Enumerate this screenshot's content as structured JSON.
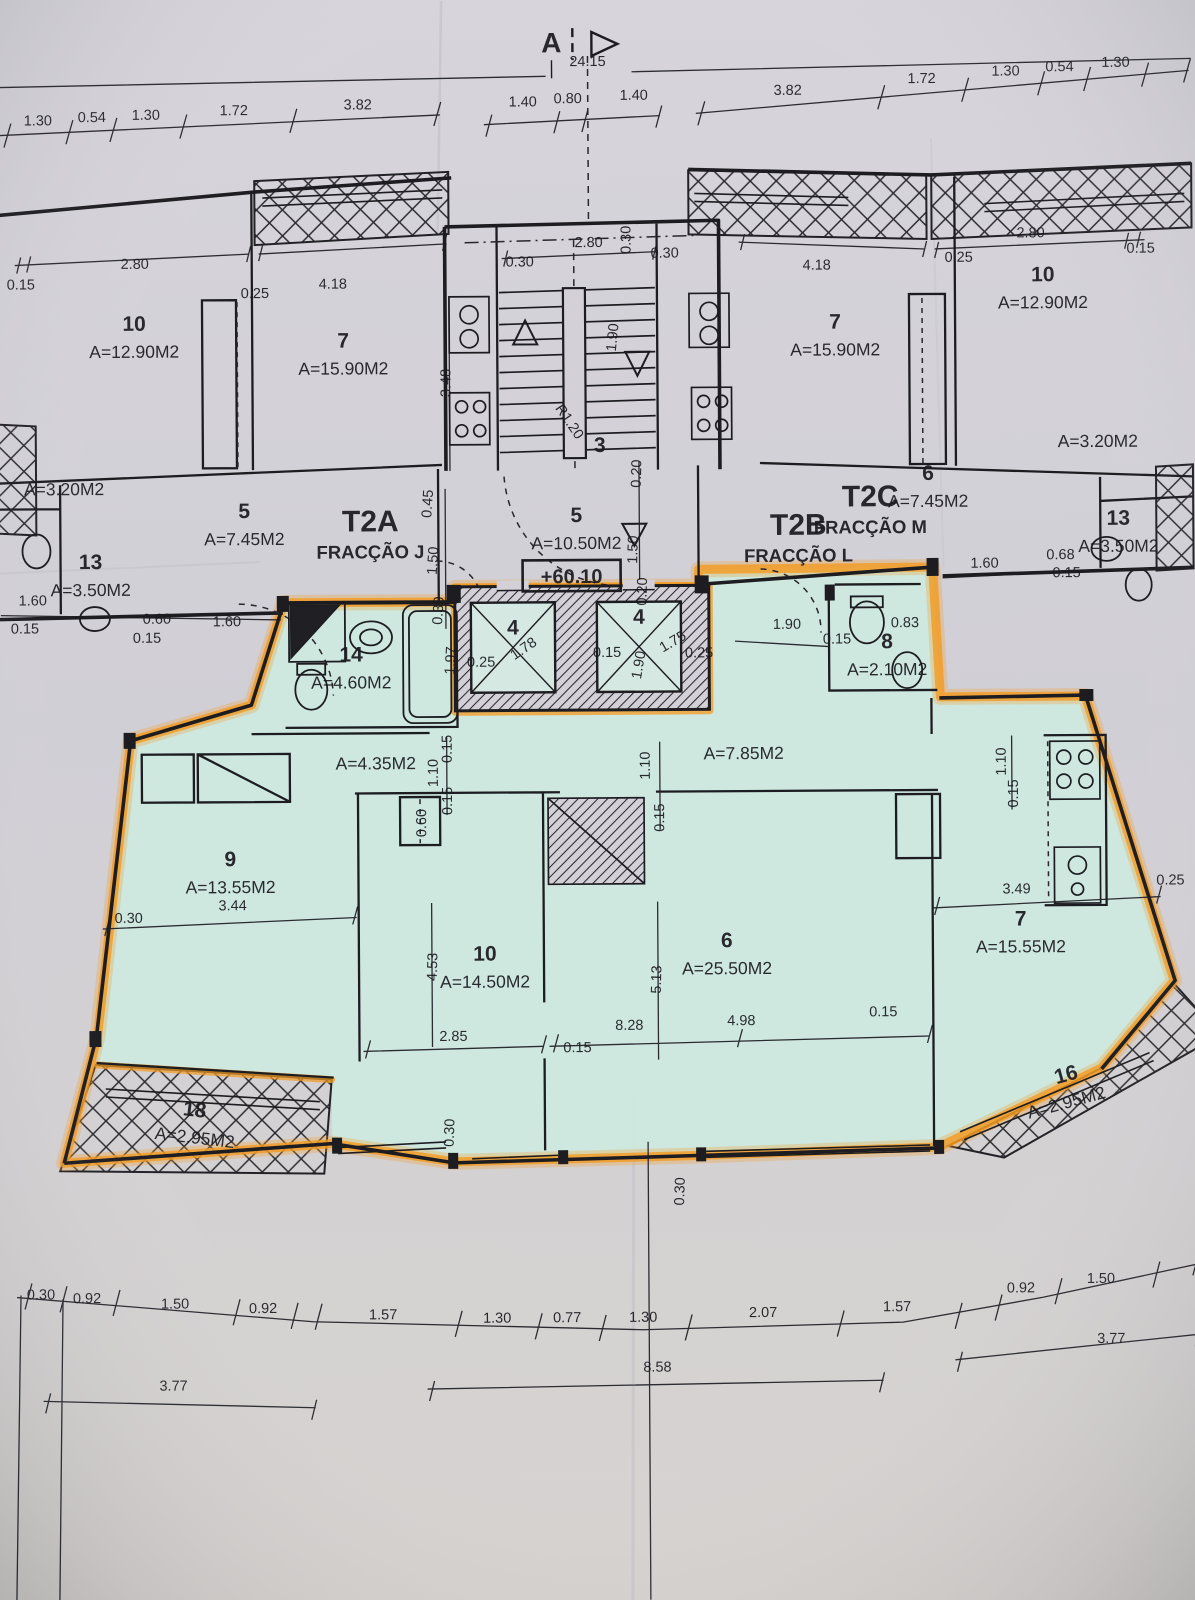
{
  "document": {
    "kind": "architectural floor plan (photographed blueprint)",
    "overall_width_label": "24.15"
  },
  "section_marker": {
    "letter": "A"
  },
  "level_marker": "+60.10",
  "colors": {
    "paper": "#d3d1d7",
    "highlight_teal": "#cde9e0",
    "highlighter_orange": "#f49a1f",
    "ink": "#1c1c20"
  },
  "fractions": [
    {
      "code": "T2A",
      "name": "FRACÇÃO J",
      "x": 372,
      "y": 530
    },
    {
      "code": "T2B",
      "name": "FRACÇÃO L",
      "x": 800,
      "y": 536
    },
    {
      "code": "T2C",
      "name": "FRACÇÃO M",
      "x": 872,
      "y": 508
    }
  ],
  "rooms": [
    {
      "n": "10",
      "a": "A=12.90M2",
      "x": 137,
      "y": 328
    },
    {
      "n": "7",
      "a": "A=15.90M2",
      "x": 346,
      "y": 346
    },
    {
      "n": "",
      "a": "A=3.20M2",
      "x": 66,
      "y": 492
    },
    {
      "n": "5",
      "a": "A=7.45M2",
      "x": 246,
      "y": 516
    },
    {
      "n": "13",
      "a": "A=3.50M2",
      "x": 92,
      "y": 566
    },
    {
      "n": "3",
      "a": "",
      "x": 602,
      "y": 452
    },
    {
      "n": "5",
      "a": "A=10.50M2",
      "x": 578,
      "y": 522
    },
    {
      "n": "7",
      "a": "A=15.90M2",
      "x": 838,
      "y": 330
    },
    {
      "n": "10",
      "a": "A=12.90M2",
      "x": 1046,
      "y": 284
    },
    {
      "n": "",
      "a": "A=3.20M2",
      "x": 1100,
      "y": 450
    },
    {
      "n": "6",
      "a": "A=7.45M2",
      "x": 930,
      "y": 482
    },
    {
      "n": "13",
      "a": "A=3.50M2",
      "x": 1120,
      "y": 528
    },
    {
      "n": "14",
      "a": "A=4.60M2",
      "x": 352,
      "y": 660
    },
    {
      "n": "4",
      "a": "",
      "x": 514,
      "y": 634
    },
    {
      "n": "4",
      "a": "",
      "x": 640,
      "y": 624
    },
    {
      "n": "8",
      "a": "A=2.10M2",
      "x": 888,
      "y": 650
    },
    {
      "n": "",
      "a": "A=4.35M2",
      "x": 376,
      "y": 768
    },
    {
      "n": "",
      "a": "A=7.85M2",
      "x": 744,
      "y": 760
    },
    {
      "n": "9",
      "a": "A=13.55M2",
      "x": 230,
      "y": 864
    },
    {
      "n": "10",
      "a": "A=14.50M2",
      "x": 484,
      "y": 960
    },
    {
      "n": "6",
      "a": "A=25.50M2",
      "x": 726,
      "y": 948
    },
    {
      "n": "7",
      "a": "A=15.55M2",
      "x": 1020,
      "y": 928
    },
    {
      "n": "18",
      "a": "A=2.95M2",
      "x": 192,
      "y": 1114,
      "r": 7
    },
    {
      "n": "16",
      "a": "A=2.95M2",
      "x": 1066,
      "y": 1084,
      "r": -15
    }
  ],
  "dimensions": [
    {
      "t": "24.15",
      "x": 592,
      "y": 66
    },
    {
      "t": "1.30",
      "x": 42,
      "y": 122
    },
    {
      "t": "0.54",
      "x": 96,
      "y": 119
    },
    {
      "t": "1.30",
      "x": 150,
      "y": 117
    },
    {
      "t": "1.72",
      "x": 238,
      "y": 113
    },
    {
      "t": "3.82",
      "x": 362,
      "y": 108
    },
    {
      "t": "1.40",
      "x": 527,
      "y": 106
    },
    {
      "t": "0.80",
      "x": 572,
      "y": 103
    },
    {
      "t": "1.40",
      "x": 638,
      "y": 100
    },
    {
      "t": "3.82",
      "x": 792,
      "y": 96
    },
    {
      "t": "1.72",
      "x": 926,
      "y": 85
    },
    {
      "t": "1.30",
      "x": 1010,
      "y": 78
    },
    {
      "t": "0.54",
      "x": 1064,
      "y": 74
    },
    {
      "t": "1.30",
      "x": 1120,
      "y": 70
    },
    {
      "t": "0.15",
      "x": 24,
      "y": 286
    },
    {
      "t": "2.80",
      "x": 138,
      "y": 266
    },
    {
      "t": "0.25",
      "x": 258,
      "y": 296
    },
    {
      "t": "4.18",
      "x": 336,
      "y": 287
    },
    {
      "t": "3.48",
      "x": 453,
      "y": 382,
      "r": -90
    },
    {
      "t": "2.80",
      "x": 592,
      "y": 247
    },
    {
      "t": "0.30",
      "x": 523,
      "y": 266
    },
    {
      "t": "0.30",
      "x": 668,
      "y": 258
    },
    {
      "t": "0.30",
      "x": 634,
      "y": 240,
      "r": -90
    },
    {
      "t": "1.90",
      "x": 620,
      "y": 338,
      "r": -84
    },
    {
      "t": "R1.20",
      "x": 568,
      "y": 424,
      "r": 56
    },
    {
      "t": "4.18",
      "x": 820,
      "y": 271
    },
    {
      "t": "0.25",
      "x": 962,
      "y": 264
    },
    {
      "t": "2.80",
      "x": 1034,
      "y": 240
    },
    {
      "t": "0.15",
      "x": 1144,
      "y": 256
    },
    {
      "t": "0.45",
      "x": 434,
      "y": 503,
      "r": -86
    },
    {
      "t": "1.50",
      "x": 439,
      "y": 560,
      "r": -86
    },
    {
      "t": "0.30",
      "x": 444,
      "y": 610,
      "r": -86
    },
    {
      "t": "1.50",
      "x": 639,
      "y": 550,
      "r": -88
    },
    {
      "t": "0.20",
      "x": 648,
      "y": 592,
      "r": -88
    },
    {
      "t": "0.20",
      "x": 643,
      "y": 474,
      "r": -88
    },
    {
      "t": "1.60",
      "x": 34,
      "y": 602
    },
    {
      "t": "0.15",
      "x": 26,
      "y": 630
    },
    {
      "t": "0.60",
      "x": 158,
      "y": 621
    },
    {
      "t": "0.15",
      "x": 148,
      "y": 640
    },
    {
      "t": "1.60",
      "x": 228,
      "y": 624
    },
    {
      "t": "1.60",
      "x": 986,
      "y": 570
    },
    {
      "t": "0.68",
      "x": 1062,
      "y": 562
    },
    {
      "t": "0.15",
      "x": 1068,
      "y": 580
    },
    {
      "t": "0.25",
      "x": 482,
      "y": 666
    },
    {
      "t": "1.78",
      "x": 527,
      "y": 652,
      "r": -34
    },
    {
      "t": "0.15",
      "x": 608,
      "y": 657
    },
    {
      "t": "1.90",
      "x": 644,
      "y": 666,
      "r": -80
    },
    {
      "t": "1.75",
      "x": 676,
      "y": 646,
      "r": -30
    },
    {
      "t": "0.25",
      "x": 700,
      "y": 658
    },
    {
      "t": "1.97",
      "x": 456,
      "y": 660,
      "r": -86
    },
    {
      "t": "1.90",
      "x": 788,
      "y": 630
    },
    {
      "t": "0.15",
      "x": 838,
      "y": 645
    },
    {
      "t": "0.83",
      "x": 906,
      "y": 629
    },
    {
      "t": "1.10",
      "x": 438,
      "y": 772,
      "r": -90
    },
    {
      "t": "0.15",
      "x": 452,
      "y": 748,
      "r": -90
    },
    {
      "t": "0.15",
      "x": 452,
      "y": 800,
      "r": -90
    },
    {
      "t": "1.10",
      "x": 650,
      "y": 766,
      "r": -90
    },
    {
      "t": "0.15",
      "x": 664,
      "y": 818,
      "r": -90
    },
    {
      "t": "1.10",
      "x": 1006,
      "y": 764,
      "r": -90
    },
    {
      "t": "0.15",
      "x": 1018,
      "y": 796,
      "r": -90
    },
    {
      "t": "0.60",
      "x": 426,
      "y": 822,
      "r": -90
    },
    {
      "t": "3.44",
      "x": 232,
      "y": 908
    },
    {
      "t": "0.30",
      "x": 128,
      "y": 920
    },
    {
      "t": "4.53",
      "x": 436,
      "y": 966,
      "r": -88
    },
    {
      "t": "2.85",
      "x": 452,
      "y": 1040
    },
    {
      "t": "0.15",
      "x": 576,
      "y": 1052
    },
    {
      "t": "5.13",
      "x": 660,
      "y": 980,
      "r": -88
    },
    {
      "t": "8.28",
      "x": 628,
      "y": 1030
    },
    {
      "t": "4.98",
      "x": 740,
      "y": 1026
    },
    {
      "t": "0.15",
      "x": 882,
      "y": 1018
    },
    {
      "t": "3.49",
      "x": 1016,
      "y": 896
    },
    {
      "t": "0.25",
      "x": 1170,
      "y": 888
    },
    {
      "t": "0.30",
      "x": 452,
      "y": 1132,
      "r": -88
    },
    {
      "t": "0.30",
      "x": 682,
      "y": 1192,
      "r": -88
    },
    {
      "t": "0.30",
      "x": 38,
      "y": 1296
    },
    {
      "t": "0.92",
      "x": 84,
      "y": 1300
    },
    {
      "t": "1.50",
      "x": 172,
      "y": 1306
    },
    {
      "t": "0.92",
      "x": 260,
      "y": 1311
    },
    {
      "t": "1.57",
      "x": 380,
      "y": 1318
    },
    {
      "t": "1.30",
      "x": 494,
      "y": 1322
    },
    {
      "t": "0.77",
      "x": 564,
      "y": 1322
    },
    {
      "t": "1.30",
      "x": 640,
      "y": 1322
    },
    {
      "t": "2.07",
      "x": 760,
      "y": 1318
    },
    {
      "t": "1.57",
      "x": 894,
      "y": 1313
    },
    {
      "t": "0.92",
      "x": 1018,
      "y": 1295
    },
    {
      "t": "1.50",
      "x": 1098,
      "y": 1286
    },
    {
      "t": "3.77",
      "x": 170,
      "y": 1388
    },
    {
      "t": "8.58",
      "x": 654,
      "y": 1372
    },
    {
      "t": "3.77",
      "x": 1108,
      "y": 1346
    }
  ]
}
